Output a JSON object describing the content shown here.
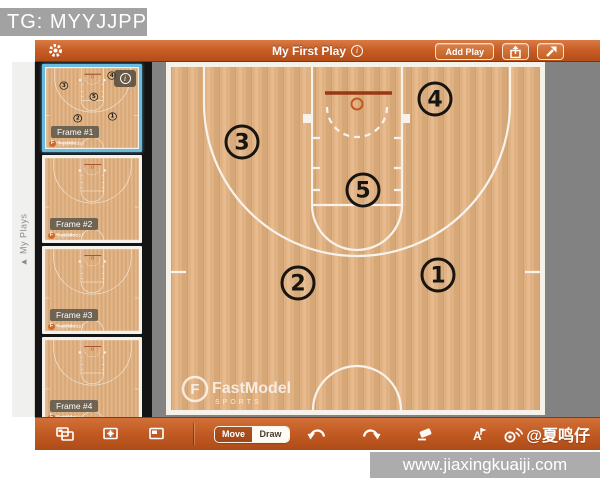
{
  "banners": {
    "tg": "TG: MYYJJPP",
    "url": "www.jiaxingkuaiji.com"
  },
  "topbar": {
    "title": "My First Play",
    "info_glyph": "i",
    "add_play_label": "Add Play"
  },
  "sidebar": {
    "collapse_label": "▲ My Plays",
    "mini_logo_text": "FastModel",
    "frames": [
      {
        "label": "Frame #1",
        "selected": true,
        "players": true,
        "info": true
      },
      {
        "label": "Frame #2",
        "selected": false,
        "players": false,
        "info": false
      },
      {
        "label": "Frame #3",
        "selected": false,
        "players": false,
        "info": false
      },
      {
        "label": "Frame #4",
        "selected": false,
        "players": false,
        "info": false
      }
    ]
  },
  "court": {
    "players": [
      {
        "label": "1",
        "x": 272,
        "y": 213
      },
      {
        "label": "2",
        "x": 132,
        "y": 221
      },
      {
        "label": "3",
        "x": 76,
        "y": 80
      },
      {
        "label": "4",
        "x": 269,
        "y": 37
      },
      {
        "label": "5",
        "x": 197,
        "y": 128
      }
    ],
    "logo": {
      "name": "FastModel",
      "sub": "SPORTS",
      "monogram": "F"
    }
  },
  "toolbar": {
    "move_label": "Move",
    "draw_label": "Draw",
    "active_mode": "Draw",
    "text_tool_glyph": "A",
    "watermark": "@夏鸣仔"
  },
  "colors": {
    "accent_orange": "#c25a22",
    "selection_blue": "#68bade",
    "court_wood": "#dfb183",
    "line_white": "#f7f3ec",
    "backboard_red": "#9a3815"
  }
}
